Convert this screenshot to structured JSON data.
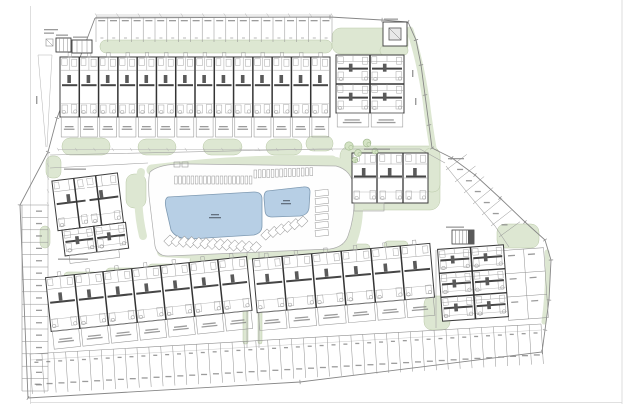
{
  "site_plan": {
    "page": {
      "w": 631,
      "h": 404,
      "borders": [
        [
          30.5,
          6,
          30.5,
          404
        ],
        [
          622,
          0,
          622,
          404
        ],
        [
          30,
          402.5,
          622,
          402.5
        ]
      ]
    },
    "colors": {
      "green": "#dde7d2",
      "green_edge": "#b9c8a7",
      "pool": "#b7cfe5",
      "pool_edge": "#7f9ab2",
      "deck": "#fefefe",
      "deck_edge": "#ababab",
      "wall": "#3d3d3d",
      "wall2": "#343434",
      "bold": "#454545",
      "light": "#979797",
      "furn": "#a6a6a6",
      "stall": "#8f8f8f",
      "road": "#a3a3a3",
      "boundary": "#878787",
      "dim": "#b3b3b3",
      "smudge": "#8a8a8a",
      "smudge_dark": "#55606e"
    },
    "boundary": {
      "points": [
        [
          95,
          18
        ],
        [
          330,
          17
        ],
        [
          382,
          20
        ],
        [
          408,
          22
        ],
        [
          416,
          40
        ],
        [
          421,
          65
        ],
        [
          425,
          95
        ],
        [
          429,
          125
        ],
        [
          432,
          148
        ],
        [
          452,
          158
        ],
        [
          475,
          175
        ],
        [
          500,
          198
        ],
        [
          525,
          222
        ],
        [
          545,
          240
        ],
        [
          551,
          260
        ],
        [
          549,
          300
        ],
        [
          545,
          330
        ],
        [
          542,
          352
        ],
        [
          300,
          382
        ],
        [
          28,
          398
        ],
        [
          20,
          205
        ],
        [
          48,
          152
        ],
        [
          57,
          118
        ],
        [
          95,
          18
        ]
      ]
    },
    "roads": [
      {
        "pts": [
          [
            50,
            155
          ],
          [
            320,
            149
          ],
          [
            420,
            149
          ],
          [
            445,
            163
          ]
        ]
      },
      {
        "pts": [
          [
            50,
            168
          ],
          [
            148,
            163
          ]
        ]
      },
      {
        "pts": [
          [
            247,
            252
          ],
          [
            247,
            348
          ]
        ]
      },
      {
        "pts": [
          [
            259,
            252
          ],
          [
            259,
            348
          ]
        ]
      },
      {
        "pts": [
          [
            436,
            250
          ],
          [
            436,
            328
          ]
        ]
      },
      {
        "pts": [
          [
            446,
            166
          ],
          [
            470,
            196
          ],
          [
            495,
            226
          ],
          [
            509,
            247
          ]
        ]
      }
    ],
    "dims": [
      {
        "x1": 96,
        "y1": 15,
        "x2": 332,
        "y2": 15,
        "ticks": 11
      },
      {
        "x1": 58,
        "y1": 149.5,
        "x2": 332,
        "y2": 149.5,
        "ticks": 15
      },
      {
        "x1": 48,
        "y1": 152,
        "x2": 48,
        "y2": 204,
        "ticks": 4
      },
      {
        "x1": 38,
        "y1": 55,
        "x2": 46,
        "y2": 147,
        "ticks": 0
      },
      {
        "x1": 52,
        "y1": 55,
        "x2": 47,
        "y2": 147,
        "ticks": 0
      },
      {
        "x1": 38,
        "y1": 55,
        "x2": 52,
        "y2": 55,
        "ticks": 0
      }
    ],
    "greens": {
      "blobs": [
        [
          100,
          40,
          232,
          13,
          6
        ],
        [
          332,
          28,
          76,
          26,
          9
        ],
        [
          380,
          46,
          28,
          9,
          4
        ],
        [
          62,
          138,
          48,
          17,
          8
        ],
        [
          138,
          139,
          38,
          16,
          8
        ],
        [
          203,
          139,
          39,
          16,
          8
        ],
        [
          266,
          139,
          36,
          16,
          8
        ],
        [
          306,
          136,
          27,
          15,
          7
        ],
        [
          46,
          156,
          15,
          22,
          6
        ],
        [
          126,
          174,
          20,
          34,
          8
        ],
        [
          40,
          226,
          10,
          22,
          5
        ],
        [
          340,
          146,
          100,
          64,
          10
        ],
        [
          424,
          148,
          16,
          44,
          7
        ],
        [
          497,
          224,
          42,
          24,
          8
        ],
        [
          424,
          296,
          26,
          34,
          8
        ],
        [
          243,
          252,
          5,
          92,
          2
        ],
        [
          258,
          252,
          4,
          92,
          2
        ],
        [
          64,
          272,
          34,
          8,
          4
        ],
        [
          106,
          268,
          34,
          8,
          4
        ],
        [
          148,
          264,
          32,
          8,
          4
        ],
        [
          190,
          257,
          26,
          7,
          3
        ],
        [
          256,
          250,
          34,
          8,
          4
        ],
        [
          298,
          247,
          34,
          8,
          4
        ],
        [
          340,
          244,
          30,
          8,
          4
        ],
        [
          384,
          241,
          24,
          8,
          4
        ]
      ],
      "ribbons": [
        {
          "d": "M152,170 Q240,159 332,161",
          "w": 11
        },
        {
          "d": "M336,163 Q356,172 357,200 Q358,228 348,248",
          "w": 12
        },
        {
          "d": "M162,252 Q250,258 340,250",
          "w": 10
        },
        {
          "d": "M141,172 Q135,202 143,236",
          "w": 8
        },
        {
          "d": "M410,30 Q420,60 426,100 Q429,125 433,148",
          "w": 7
        },
        {
          "d": "M547,252 Q549,285 544,322",
          "w": 5
        }
      ]
    },
    "trees": [
      [
        349,
        146,
        4.2
      ],
      [
        358,
        153,
        3.4
      ],
      [
        367,
        143,
        3.9
      ],
      [
        375,
        151,
        3.0
      ],
      [
        355,
        160,
        2.8
      ]
    ],
    "deck": {
      "d": "M150,172 Q148,178 149,196 L155,246 Q157,256 168,256 L330,249 Q344,247 348,236 Q356,214 354,188 Q352,170 336,166 L190,164 Q160,163 150,172 Z",
      "marks": [
        [
          174,
          162,
          6,
          5
        ],
        [
          182,
          162,
          6,
          5
        ]
      ]
    },
    "pools": [
      {
        "name": "pool-large",
        "d": "M168,197 L254,192 Q262,192 262,199 L262,226 Q262,233 254,235 L190,239 Q176,239 171,230 L166,208 Q164,199 168,197 Z"
      },
      {
        "name": "pool-small",
        "d": "M267,191 L303,187 Q310,186 310,192 L309,208 Q308,215 300,216 L272,217 Q265,217 265,210 L264,198 Q264,192 267,191 Z"
      }
    ],
    "loungers": {
      "top1": {
        "x0": 174.5,
        "y": 176,
        "n": 19,
        "dx": 4.15,
        "w": 2.7,
        "h": 8
      },
      "top2": {
        "x0": 254,
        "y": 170,
        "n": 14,
        "dx": 4.3,
        "w": 2.7,
        "h": 8
      },
      "right_col": {
        "x": 315,
        "y0": 190,
        "n": 6,
        "dy": 8,
        "w": 13,
        "h": 6
      },
      "diag1": {
        "x0": 170,
        "y0": 235,
        "n": 13,
        "dx": 7.2,
        "dy": 0.55,
        "s": 7
      },
      "diag2": {
        "x0": 267,
        "y0": 229,
        "n": 6,
        "dx": 7.2,
        "dy": -2.6,
        "s": 7
      }
    },
    "parking": {
      "top_row": {
        "x": 96,
        "y": 17,
        "count": 20,
        "stall_w": 11.8,
        "depth": 25
      },
      "left_col": {
        "x": 22,
        "y": 205,
        "count": 15,
        "stall_h": 12.4,
        "width": 26
      },
      "bottom_row": {
        "x": 30,
        "y": 354,
        "ex": 541,
        "ey": 324,
        "count": 43,
        "depth": 40
      },
      "curve_stalls": {
        "pts": [
          [
            446,
            170
          ],
          [
            455,
            182
          ],
          [
            464,
            193
          ],
          [
            473,
            204
          ],
          [
            482,
            215
          ],
          [
            491,
            226
          ],
          [
            499,
            237
          ]
        ],
        "len": 26
      },
      "right_grid": {
        "x": 506,
        "y": 249,
        "cols": 2,
        "rows": 3,
        "w": 40,
        "h": 70,
        "rot": -4,
        "cx": 526,
        "cy": 284
      }
    },
    "buildings": {
      "rows": [
        {
          "name": "townhouse-row-north",
          "x": 60,
          "y": 57,
          "w": 270,
          "h": 60,
          "units": 14,
          "terrace_h": 20,
          "rot": 0,
          "cx": 0,
          "cy": 0
        },
        {
          "name": "townhouse-row-southwest",
          "x": 48,
          "y": 267,
          "w": 202,
          "h": 54,
          "units": 7,
          "terrace_h": 18,
          "rot": -6,
          "cx": 149,
          "cy": 296
        },
        {
          "name": "townhouse-row-south",
          "x": 255,
          "y": 251,
          "w": 178,
          "h": 54,
          "units": 6,
          "terrace_h": 18,
          "rot": -5,
          "cx": 344,
          "cy": 284
        }
      ],
      "grids": [
        {
          "name": "townhouse-block-northeast",
          "x": 336,
          "y": 55,
          "w": 68,
          "h": 58,
          "cols": 2,
          "rows": 2,
          "rot": 0,
          "cx": 0,
          "cy": 0,
          "terrace_h": 14
        },
        {
          "name": "apartment-block-southeast",
          "x": 440,
          "y": 247,
          "w": 66,
          "h": 72,
          "cols": 2,
          "rows": 3,
          "rot": -4,
          "cx": 473,
          "cy": 283,
          "terrace_h": 0
        }
      ],
      "cluster": {
        "name": "apartment-cluster-west",
        "rot": -7,
        "cx": 95,
        "cy": 212,
        "rects": [
          [
            56,
            176,
            66,
            50
          ],
          [
            60,
            226,
            64,
            26
          ]
        ],
        "walls": [
          [
            78,
            176,
            78,
            226
          ],
          [
            100,
            176,
            100,
            226
          ],
          [
            92,
            226,
            92,
            252
          ]
        ],
        "terrace": [
          64,
          252,
          50,
          8
        ]
      },
      "clubhouse": {
        "name": "clubhouse-building",
        "x": 352,
        "y": 153,
        "w": 76,
        "h": 50,
        "vlines": [
          377,
          403
        ],
        "hline": 178,
        "terrace": [
          354,
          203,
          30,
          8
        ]
      }
    },
    "structures": {
      "hut": {
        "outer": [
          383,
          22,
          24,
          24
        ],
        "inner": [
          389,
          28,
          12,
          12
        ]
      },
      "utility": [
        [
          56,
          38,
          15,
          14
        ],
        [
          72,
          40,
          20,
          13
        ]
      ],
      "legend_box": [
        46,
        39,
        7,
        7
      ],
      "stair": {
        "rect": [
          452,
          230,
          22,
          14
        ],
        "dark": [
          468,
          230,
          6,
          14
        ]
      }
    },
    "smudges": [
      {
        "x": 384,
        "y": 18.5,
        "w": 14
      },
      {
        "x": 56,
        "y": 34.5,
        "w": 12
      },
      {
        "x": 73,
        "y": 36.5,
        "w": 15
      },
      {
        "x": 44,
        "y": 29,
        "w": 14
      },
      {
        "x": 44,
        "y": 32.5,
        "w": 10
      },
      {
        "x": 36,
        "y": 96,
        "w": 1.4,
        "h": 8
      },
      {
        "x": 64,
        "y": 168.5,
        "w": 22
      },
      {
        "x": 364,
        "y": 148.5,
        "w": 26
      },
      {
        "x": 58,
        "y": 258.5,
        "w": 30
      },
      {
        "x": 446,
        "y": 226.5,
        "w": 18
      },
      {
        "x": 448,
        "y": 158,
        "w": 16
      },
      {
        "x": 412,
        "y": 70,
        "w": 1.4,
        "h": 7
      },
      {
        "x": 415,
        "y": 98,
        "w": 1.4,
        "h": 7
      },
      {
        "x": 211,
        "y": 214,
        "w": 8,
        "dark": true
      },
      {
        "x": 209,
        "y": 217,
        "w": 12,
        "dark": true
      },
      {
        "x": 283,
        "y": 200,
        "w": 7,
        "dark": true
      },
      {
        "x": 281,
        "y": 203,
        "w": 10,
        "dark": true
      }
    ]
  }
}
